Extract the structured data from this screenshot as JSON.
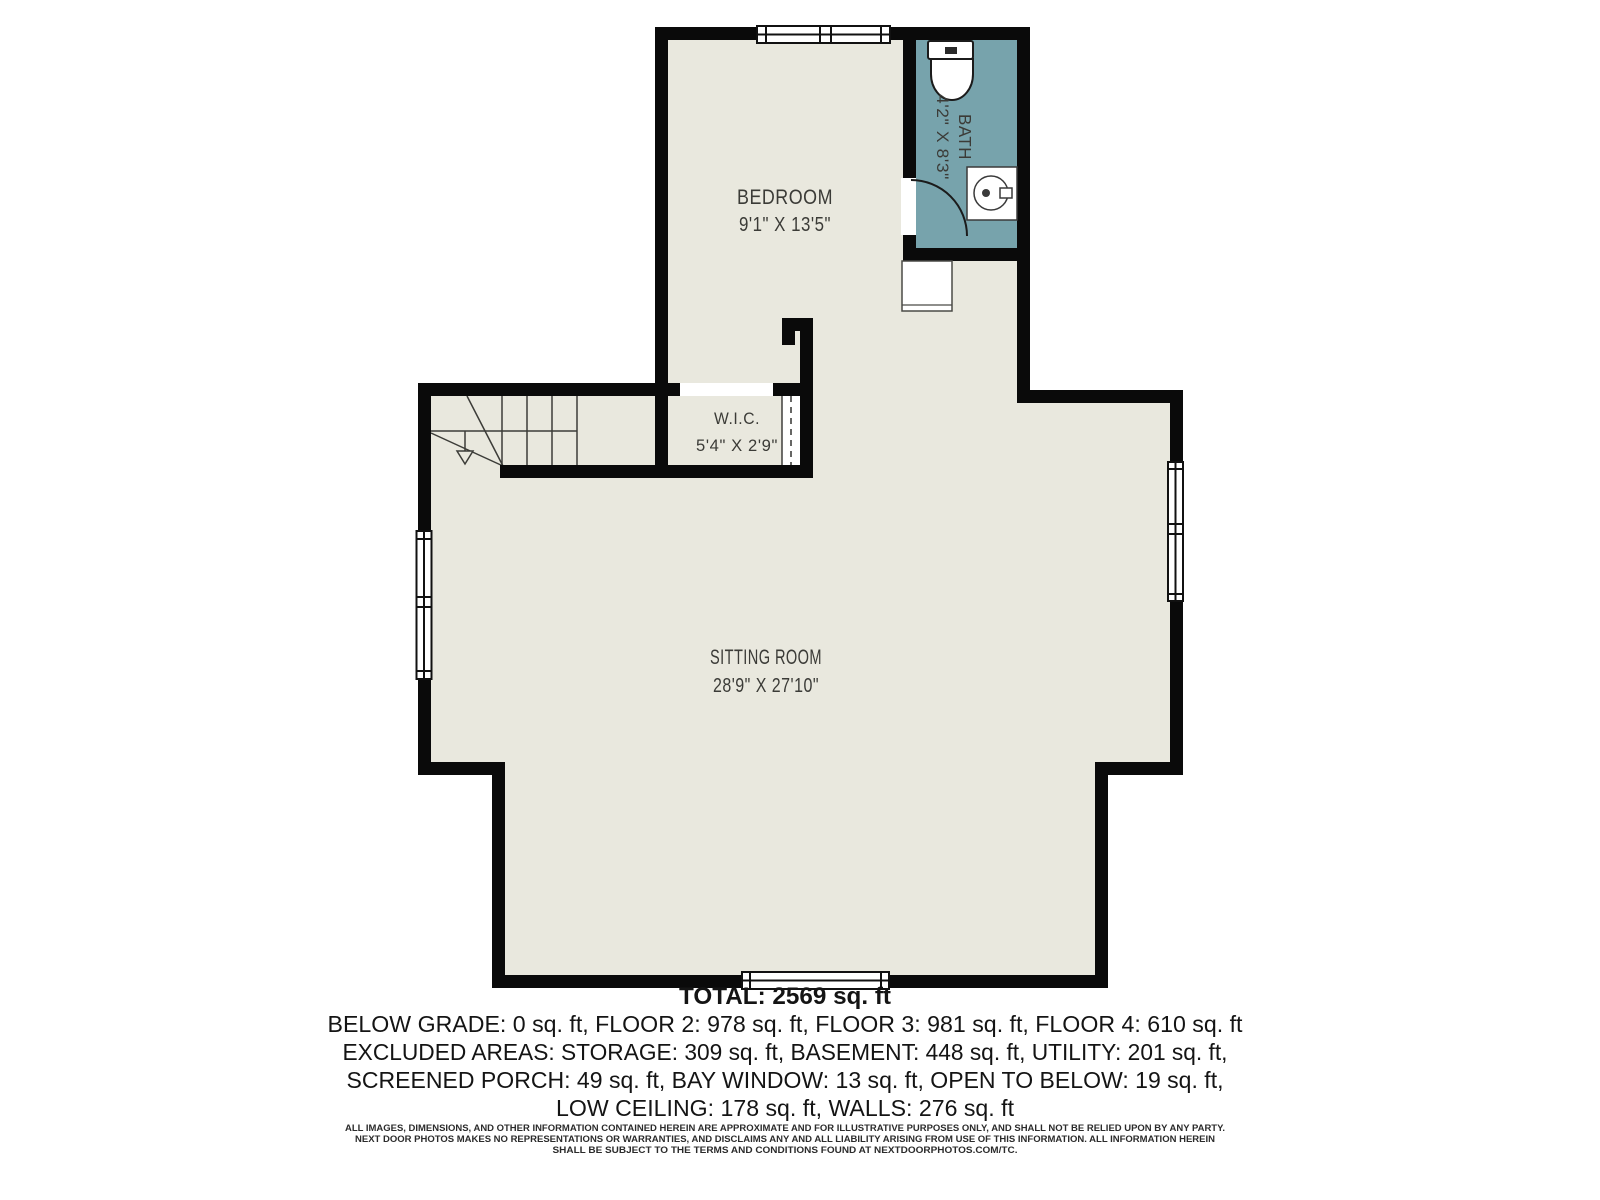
{
  "plan": {
    "rooms": [
      {
        "name": "BEDROOM",
        "dims": "9'1\" X 13'5\""
      },
      {
        "name": "BATH",
        "dims": "4'2\" X 8'3\""
      },
      {
        "name": "W.I.C.",
        "dims": "5'4\" X 2'9\""
      },
      {
        "name": "SITTING ROOM",
        "dims": "28'9\" X 27'10\""
      }
    ],
    "colors": {
      "floor": "#e9e8de",
      "bath_floor": "#77a3ac",
      "wall": "#0a0a0a",
      "fixture_line": "#3c3c38"
    }
  },
  "summary": {
    "total": "TOTAL: 2569 sq. ft",
    "line1": "BELOW GRADE: 0 sq. ft, FLOOR 2: 978 sq. ft, FLOOR 3: 981 sq. ft, FLOOR 4: 610 sq. ft",
    "line2": "EXCLUDED AREAS: STORAGE: 309 sq. ft, BASEMENT: 448 sq. ft, UTILITY: 201 sq. ft,",
    "line3": "SCREENED PORCH: 49 sq. ft, BAY WINDOW: 13 sq. ft, OPEN TO BELOW: 19 sq. ft,",
    "line4": "LOW CEILING: 178 sq. ft, WALLS: 276 sq. ft"
  },
  "disclaimer": {
    "line1": "ALL IMAGES, DIMENSIONS, AND OTHER INFORMATION CONTAINED HEREIN ARE APPROXIMATE AND FOR ILLUSTRATIVE PURPOSES ONLY, AND SHALL NOT BE RELIED UPON BY ANY PARTY.",
    "line2": "NEXT DOOR PHOTOS MAKES NO REPRESENTATIONS OR WARRANTIES, AND DISCLAIMS ANY AND ALL LIABILITY ARISING FROM USE OF THIS INFORMATION. ALL INFORMATION HEREIN",
    "line3": "SHALL BE SUBJECT TO THE TERMS AND CONDITIONS FOUND AT NEXTDOORPHOTOS.COM/TC."
  }
}
